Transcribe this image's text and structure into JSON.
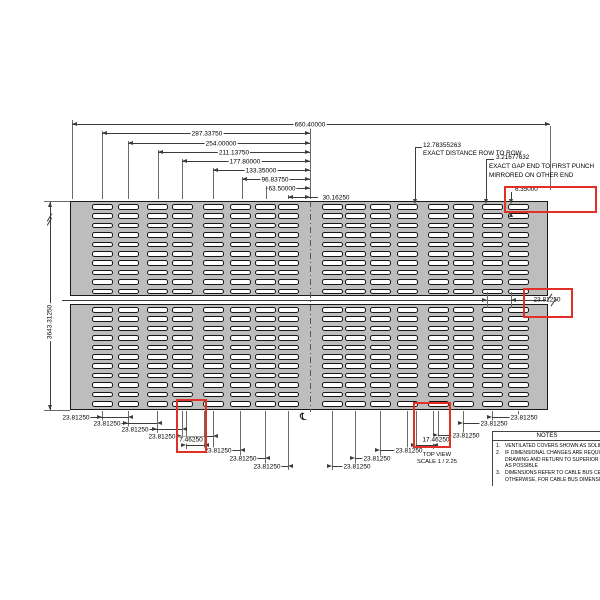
{
  "colors": {
    "panel_fill": "#bdbdbd",
    "panel_border": "#1a1a1a",
    "line": "#3c3c3c",
    "ext_line": "#6a6a6a",
    "text": "#000000",
    "highlight_red": "#e03127",
    "slot_fill": "#ffffff",
    "background": "#ffffff"
  },
  "view": {
    "title": "TOP VIEW",
    "scale": "SCALE 1 / 2.25",
    "centerline_symbol": "℄"
  },
  "dimensions": {
    "overall_width": "660.40000",
    "left_height": "3643.31250",
    "seam_gap": "23.81250",
    "top_chain": [
      {
        "y": 124,
        "x1": 72,
        "x2": 550,
        "lx": 310,
        "label": "660.40000"
      },
      {
        "y": 133,
        "x1": 102,
        "x2": 310,
        "lx": 207,
        "label": "287.33750"
      },
      {
        "y": 143,
        "x1": 128,
        "x2": 310,
        "lx": 221,
        "label": "254.00000"
      },
      {
        "y": 152,
        "x1": 158,
        "x2": 310,
        "lx": 234,
        "label": "211.13750"
      },
      {
        "y": 161,
        "x1": 182,
        "x2": 310,
        "lx": 245,
        "label": "177.80000"
      },
      {
        "y": 170,
        "x1": 213,
        "x2": 310,
        "lx": 261,
        "label": "133.35000"
      },
      {
        "y": 179,
        "x1": 242,
        "x2": 310,
        "lx": 275,
        "label": "96.83750"
      },
      {
        "y": 188,
        "x1": 266,
        "x2": 310,
        "lx": 282,
        "label": "63.50000"
      },
      {
        "y": 197,
        "x1": 288,
        "x2": 310,
        "lx": 336,
        "label": "30.16250",
        "label_outside": true
      }
    ],
    "bottom_chain": [
      {
        "y": 417,
        "x1": 102,
        "x2": 128,
        "lx": 76,
        "side": "left",
        "label": "23.81250"
      },
      {
        "y": 423,
        "x1": 128,
        "x2": 157,
        "lx": 107,
        "side": "left",
        "label": "23.81250"
      },
      {
        "y": 429,
        "x1": 157,
        "x2": 182,
        "lx": 135,
        "side": "left",
        "label": "23.81250"
      },
      {
        "y": 436,
        "x1": 182,
        "x2": 213,
        "lx": 162,
        "side": "left",
        "label": "23.81250"
      },
      {
        "y": 445,
        "x1": 186,
        "x2": 204,
        "lx": 191,
        "ly": 439,
        "side": "left",
        "label": "7.46250",
        "red": true
      },
      {
        "y": 450,
        "x1": 213,
        "x2": 240,
        "lx": 218,
        "side": "left",
        "label": "23.81250"
      },
      {
        "y": 458,
        "x1": 240,
        "x2": 265,
        "lx": 243,
        "side": "left",
        "label": "23.81250"
      },
      {
        "y": 466,
        "x1": 265,
        "x2": 288,
        "lx": 267,
        "side": "left",
        "label": "23.81250"
      },
      {
        "y": 417,
        "x1": 492,
        "x2": 518,
        "lx": 524,
        "side": "right",
        "label": "23.81250"
      },
      {
        "y": 423,
        "x1": 463,
        "x2": 492,
        "lx": 494,
        "side": "right",
        "label": "23.81250"
      },
      {
        "y": 435,
        "x1": 438,
        "x2": 463,
        "lx": 466,
        "side": "right",
        "label": "23.81250"
      },
      {
        "y": 445,
        "x1": 416,
        "x2": 433,
        "lx": 436,
        "ly": 439,
        "side": "right",
        "label": "17.46250",
        "red": true
      },
      {
        "y": 450,
        "x1": 380,
        "x2": 407,
        "lx": 409,
        "side": "right",
        "label": "23.81250"
      },
      {
        "y": 458,
        "x1": 355,
        "x2": 380,
        "lx": 377,
        "side": "right",
        "label": "23.81250"
      },
      {
        "y": 466,
        "x1": 332,
        "x2": 355,
        "lx": 357,
        "side": "right",
        "label": "23.81250"
      }
    ]
  },
  "callouts": {
    "row_to_row": {
      "value": "12.78355263",
      "note": "EXACT DISTANCE ROW TO ROW"
    },
    "end_gap": {
      "value": "3.21677632",
      "note_line1": "EXACT GAP END TO FIRST PUNCH",
      "note_line2": "MIRRORED ON OTHER END"
    },
    "punch_height": {
      "value": "6.35000"
    }
  },
  "notes": {
    "title": "NOTES",
    "rows": [
      {
        "num": "1.",
        "text": "VENTILATED COVERS SHOWN AS SOLID FOR"
      },
      {
        "num": "2.",
        "text": "IF DIMENSIONAL CHANGES ARE REQUIRED PL"
      },
      {
        "num": "",
        "text": "DRAWING AND RETURN TO SUPERIOR TRAY"
      },
      {
        "num": "",
        "text": "AS POSSIBLE"
      },
      {
        "num": "3.",
        "text": "DIMENSIONS REFER TO CABLE BUS CENTERLI"
      },
      {
        "num": "",
        "text": "OTHERWISE, FOR CABLE BUS DIMENSIONS R"
      }
    ]
  },
  "geometry": {
    "panel_top": [
      70,
      201,
      478,
      95
    ],
    "panel_bottom": [
      70,
      304,
      478,
      106
    ],
    "slot_cols": [
      102,
      128,
      157,
      182,
      213,
      240,
      265,
      288,
      332,
      355,
      380,
      407,
      438,
      463,
      492,
      518
    ],
    "slot": {
      "w": 21,
      "h": 5.5
    },
    "rows_top": {
      "start": 204,
      "pitch": 9.4,
      "count": 10
    },
    "rows_bottom": {
      "start": 307,
      "pitch": 9.4,
      "count": 11
    },
    "centerline_x": 310,
    "top_exts": [
      [
        72,
        120
      ],
      [
        102,
        131
      ],
      [
        128,
        141
      ],
      [
        158,
        150
      ],
      [
        182,
        159
      ],
      [
        213,
        168
      ],
      [
        242,
        177
      ],
      [
        266,
        186
      ],
      [
        288,
        195
      ],
      [
        310,
        126
      ]
    ],
    "right_ext": [
      550,
      126,
      190
    ],
    "bottom_exts": [
      [
        102,
        421
      ],
      [
        128,
        427
      ],
      [
        157,
        433
      ],
      [
        182,
        440
      ],
      [
        186,
        449
      ],
      [
        204,
        449
      ],
      [
        213,
        454
      ],
      [
        240,
        462
      ],
      [
        265,
        470
      ],
      [
        288,
        470
      ],
      [
        332,
        470
      ],
      [
        355,
        470
      ],
      [
        380,
        462
      ],
      [
        407,
        454
      ],
      [
        416,
        449
      ],
      [
        433,
        449
      ],
      [
        438,
        439
      ],
      [
        463,
        439
      ],
      [
        492,
        427
      ],
      [
        518,
        421
      ]
    ],
    "leaders": [
      {
        "segs": [
          [
            415,
            147,
            422,
            147
          ],
          [
            415,
            147,
            415,
            200
          ]
        ],
        "arrow": [
          415,
          204,
          "down"
        ]
      },
      {
        "segs": [
          [
            486,
            159,
            494,
            159
          ],
          [
            486,
            159,
            486,
            200
          ]
        ],
        "arrow": [
          486,
          204,
          "down"
        ]
      },
      {
        "segs": [
          [
            511,
            192,
            511,
            200
          ]
        ],
        "arrow": [
          511,
          204,
          "down"
        ]
      },
      {
        "segs": [
          [
            511,
            212,
            511,
            217
          ]
        ],
        "arrow": [
          511,
          212,
          "up"
        ]
      }
    ],
    "seam": {
      "line": [
        62,
        300,
        546
      ],
      "dim": {
        "x1": 487,
        "x2": 511,
        "y": 300,
        "ext_y1": 292,
        "ext_y2": 308,
        "tail_to": 527
      }
    },
    "left_dim": {
      "x": 50,
      "y1": 202,
      "y2": 410,
      "tick_x1": 44,
      "tick_x2": 70
    },
    "red_boxes": [
      [
        504,
        186,
        93,
        27
      ],
      [
        523,
        288,
        50,
        30
      ],
      [
        176,
        399,
        31,
        54
      ],
      [
        413,
        402,
        38,
        46
      ]
    ],
    "cl_symbol_pos": [
      300,
      413
    ]
  }
}
